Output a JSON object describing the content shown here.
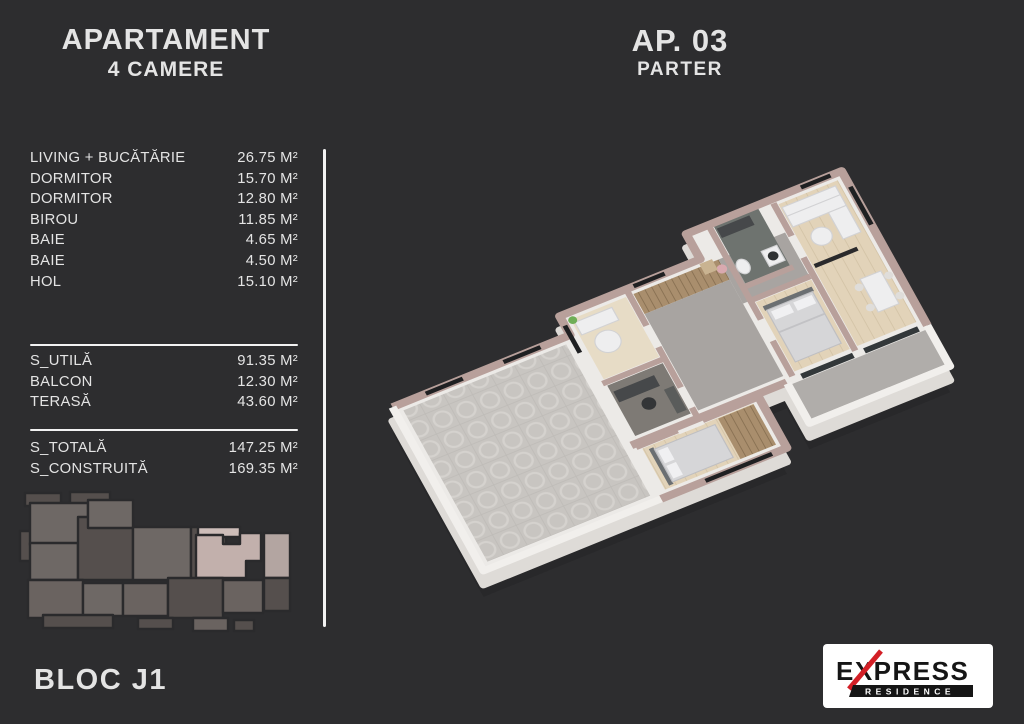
{
  "palette": {
    "bg": "#2d2d2f",
    "text": "#e4e4e4",
    "line": "#f2f2f2",
    "hl": "#c2b0ac",
    "hl_light": "#cdbdb9",
    "kp_g1": "#6e6865",
    "kp_g2": "#554f4d",
    "kp_g3": "#6a6360",
    "kp_light": "#b3a5a1",
    "kp_outline": "#2a2a2c",
    "wall_top": "#b8a09b",
    "wall_white": "#eceae7",
    "wall_side": "#dedbd7",
    "wood": "#e2d3b9",
    "wood_dark": "#a98e6d",
    "marble": "#a8a4a1",
    "marble_dark": "#6e736f",
    "terrace": "#c8c5c1",
    "logo_red": "#d31f26",
    "logo_black": "#151515",
    "logo_bg": "#ffffff"
  },
  "header": {
    "title": "APARTAMENT",
    "subtitle": "4 CAMERE"
  },
  "unit": {
    "number": "AP. 03",
    "level": "PARTER"
  },
  "rooms": [
    {
      "label": "LIVING + BUCĂTĂRIE",
      "area": "26.75 M²"
    },
    {
      "label": "DORMITOR",
      "area": "15.70 M²"
    },
    {
      "label": "DORMITOR",
      "area": "12.80 M²"
    },
    {
      "label": "BIROU",
      "area": "11.85 M²"
    },
    {
      "label": "BAIE",
      "area": "4.65 M²"
    },
    {
      "label": "BAIE",
      "area": "4.50 M²"
    },
    {
      "label": "HOL",
      "area": "15.10 M²"
    }
  ],
  "summary": [
    {
      "label": "S_UTILĂ",
      "area": "91.35 M²"
    },
    {
      "label": "BALCON",
      "area": "12.30 M²"
    },
    {
      "label": "TERASĂ",
      "area": "43.60 M²"
    }
  ],
  "totals": [
    {
      "label": "S_TOTALĂ",
      "area": "147.25 M²"
    },
    {
      "label": "S_CONSTRUITĂ",
      "area": "169.35 M²"
    }
  ],
  "block": {
    "label": "BLOC J1"
  },
  "logo": {
    "brand": "EXPRESS",
    "sub": "RESIDENCE"
  }
}
